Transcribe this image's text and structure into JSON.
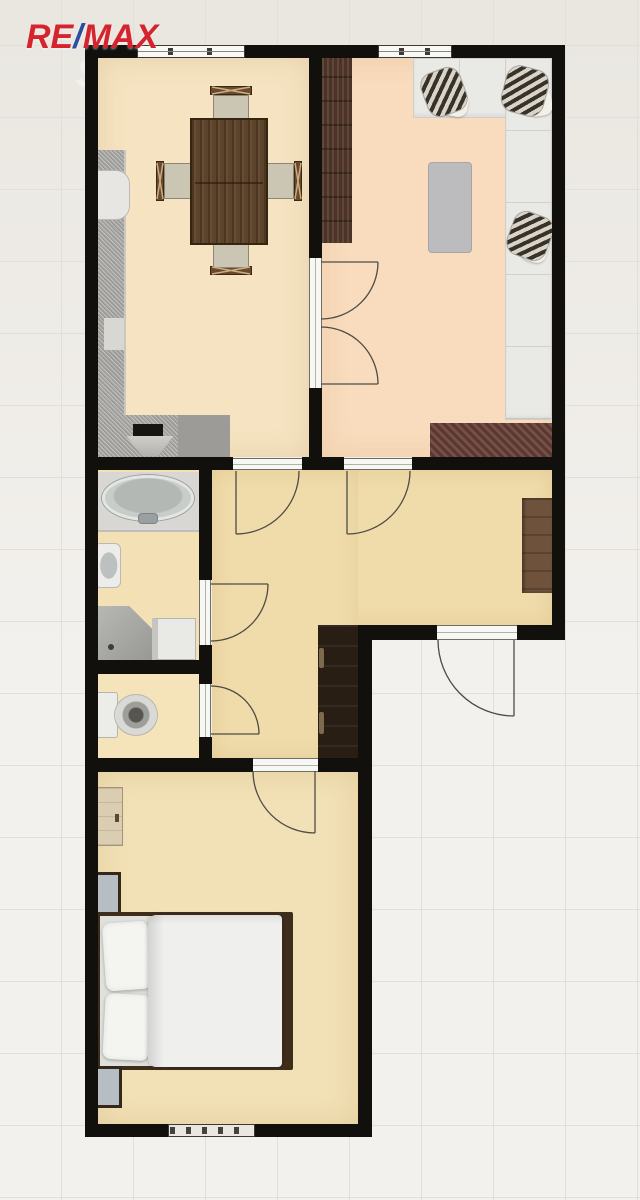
{
  "branding": {
    "logo": {
      "re": "RE",
      "slash": "/",
      "max": "MAX"
    },
    "watermark": "Sreality.cz"
  },
  "colors": {
    "bg": "#f3f1ed",
    "grid_line": "#e2dfd8",
    "wall": "#12100d",
    "floor_dining": "#f5e3c1",
    "floor_living": "#f8dcbd",
    "floor_hall": "#f0dcab",
    "floor_bath": "#f3e0b4",
    "floor_wc": "#f5e3ba",
    "floor_bedroom": "#f2e1b6",
    "logo_red": "#d5242d",
    "logo_blue": "#2b4ea1",
    "watermark": "#ffffff"
  },
  "floorplan": {
    "type": "apartment-floor-plan",
    "rooms": [
      {
        "id": "kitchen-dining",
        "position": "top-left",
        "furniture": [
          "kitchen counter L-shape",
          "cooktop-sink",
          "white cabinet",
          "dining table",
          "4 chairs"
        ]
      },
      {
        "id": "living-room",
        "position": "top-right",
        "furniture": [
          "corner sofa",
          "3 patterned pillows",
          "coffee table",
          "tall wardrobe",
          "dark rug"
        ]
      },
      {
        "id": "bathroom",
        "position": "middle-left",
        "furniture": [
          "bathtub",
          "washbasin",
          "corner shower",
          "washing machine"
        ]
      },
      {
        "id": "wc",
        "position": "middle-left-lower",
        "furniture": [
          "toilet"
        ]
      },
      {
        "id": "hallway",
        "position": "middle",
        "furniture": [
          "wall cabinet",
          "dark wardrobe"
        ]
      },
      {
        "id": "bedroom",
        "position": "bottom",
        "furniture": [
          "double bed",
          "dresser",
          "mirror",
          "mirror"
        ]
      }
    ],
    "doors": [
      "double-door dining-living",
      "dining-hall",
      "living-hall",
      "bathroom",
      "wc",
      "entrance",
      "bedroom"
    ],
    "windows": [
      "dining top window",
      "living top window",
      "bedroom bottom window-radiator"
    ]
  }
}
